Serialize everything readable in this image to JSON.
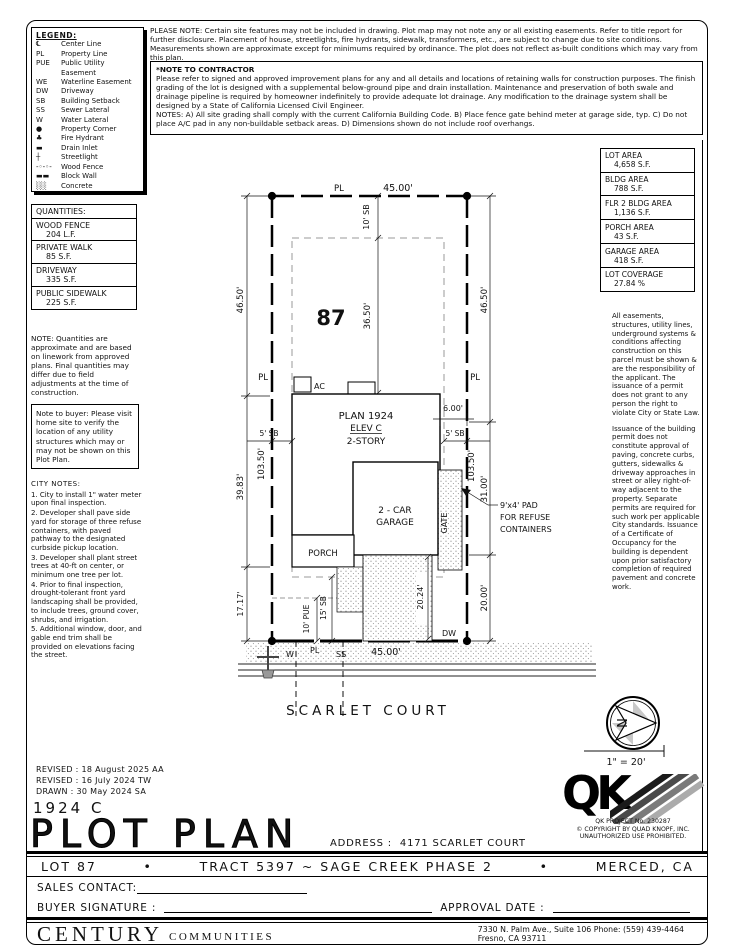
{
  "legend": {
    "title": "LEGEND:",
    "items": [
      {
        "symbol": "℄",
        "label": "Center Line"
      },
      {
        "symbol": "PL",
        "label": "Property Line"
      },
      {
        "symbol": "PUE",
        "label": "Public Utility Easement"
      },
      {
        "symbol": "WE",
        "label": "Waterline Easement"
      },
      {
        "symbol": "DW",
        "label": "Driveway"
      },
      {
        "symbol": "SB",
        "label": "Building Setback"
      },
      {
        "symbol": "SS",
        "label": "Sewer Lateral"
      },
      {
        "symbol": "W",
        "label": "Water Lateral"
      },
      {
        "symbol": "●",
        "label": "Property Corner"
      },
      {
        "symbol": "♣",
        "label": "Fire Hydrant"
      },
      {
        "symbol": "▬",
        "label": "Drain Inlet"
      },
      {
        "symbol": "┼",
        "label": "Streetlight"
      },
      {
        "symbol": "-◦-◦-",
        "label": "Wood Fence"
      },
      {
        "symbol": "▬▬",
        "label": "Block Wall"
      },
      {
        "symbol": "░░",
        "label": "Concrete"
      }
    ]
  },
  "please_note": "PLEASE NOTE:  Certain site features may not be included in drawing.  Plot map may not note any or all existing easements. Refer to title report for further disclosure.  Placement of house, streetlights, fire hydrants, sidewalk, transformers, etc., are subject to change due to site conditions.  Measurements shown are approximate except for minimums required by ordinance.  The plot does not reflect as-built conditions which may vary from this plan.",
  "contractor_note": {
    "title": "*NOTE TO CONTRACTOR",
    "body": "Please refer to signed and approved improvement plans for any and all details and locations of retaining walls for construction purposes. The finish grading of the lot is designed with a supplemental below-ground pipe and drain installation.  Maintenance and preservation of both swale and drainage pipeline is required by homeowner indefinitely to provide adequate lot drainage.  Any modification to the drainage system shall be designed by a State of California Licensed Civil Engineer.",
    "notes": "NOTES:  A) All site grading shall comply with the current California Building Code.  B) Place fence gate behind meter at garage side, typ.  C) Do not place A/C pad in any non-buildable setback areas.  D) Dimensions shown do not include roof overhangs."
  },
  "quantities": {
    "title": "QUANTITIES:",
    "rows": [
      {
        "label": "WOOD FENCE",
        "value": "204 L.F."
      },
      {
        "label": "PRIVATE WALK",
        "value": "85 S.F."
      },
      {
        "label": "DRIVEWAY",
        "value": "335 S.F."
      },
      {
        "label": "PUBLIC SIDEWALK",
        "value": "225 S.F."
      }
    ],
    "note": "NOTE: Quantities are approximate and are based on linework from approved plans.  Final quantities may differ due to field adjustments at the time of construction."
  },
  "buyer_note": "Note to buyer: Please visit home site to verify the location of any utility structures which may or may not be shown on this Plot Plan.",
  "city_notes": {
    "title": "CITY NOTES:",
    "items": [
      "1. City to install 1\" water meter upon final inspection.",
      "2. Developer shall pave side yard for storage of three refuse containers, with paved pathway to the designated curbside pickup location.",
      "3. Developer shall plant street trees at 40-ft on center, or minimum one tree per lot.",
      "4. Prior to final inspection, drought-tolerant front yard landscaping shall be provided, to include trees, ground cover, shrubs, and irrigation.",
      "5. Additional window, door, and gable end trim shall be provided on elevations facing the street."
    ]
  },
  "areas": {
    "rows": [
      {
        "label": "LOT AREA",
        "value": "4,658 S.F."
      },
      {
        "label": "BLDG AREA",
        "value": "788 S.F."
      },
      {
        "label": "FLR 2 BLDG AREA",
        "value": "1,136 S.F."
      },
      {
        "label": "PORCH AREA",
        "value": "43 S.F."
      },
      {
        "label": "GARAGE AREA",
        "value": "418 S.F."
      },
      {
        "label": "LOT COVERAGE",
        "value": "27.84 %"
      }
    ]
  },
  "right_notes": {
    "para1": "All easements, structures, utility lines, underground systems & conditions affecting construction on this parcel must be shown & are the responsibility of the applicant. The issuance of a permit does not grant to any person the right to violate City or State Law.",
    "para2": "Issuance of the building permit does not constitute approval of paving, concrete curbs, gutters, sidewalks & driveway approaches in street or alley right-of-way adjacent to the property. Separate permits are required for such work per applicable City standards. Issuance of a Certificate of Occupancy for the building is dependent upon prior satisfactory completion of required pavement and concrete work."
  },
  "plan": {
    "lot_number": "87",
    "pl": "PL",
    "street": "SCARLET COURT",
    "labels": {
      "ac": "AC",
      "plan1": "PLAN 1924",
      "plan2": "ELEV C",
      "plan3": "2-STORY",
      "garage1": "2 - CAR",
      "garage2": "GARAGE",
      "porch": "PORCH",
      "gate": "GATE",
      "dw": "DW",
      "w": "W",
      "ss": "SS",
      "refuse1": "9'x4' PAD",
      "refuse2": "FOR REFUSE",
      "refuse3": "CONTAINERS"
    },
    "dims": {
      "top_width": "45.00'",
      "front_sb": "10' SB",
      "to_house": "36.50'",
      "left1": "46.50'",
      "left2": "39.83'",
      "left3": "17.17'",
      "left_total": "103.50'",
      "right1": "46.50'",
      "right2": "31.00'",
      "right3": "20.00'",
      "right_total": "103.50'",
      "sb_left": "5' SB",
      "sb_right": "5' SB",
      "side": "6.00'",
      "pue": "10' PUE",
      "street_sb": "15' SB",
      "drive": "20.24'",
      "bottom_width": "45.00'"
    }
  },
  "compass": {
    "letter": "N",
    "scale": "1\" = 20'"
  },
  "revisions": [
    "REVISED : 18 August 2025  AA",
    "REVISED : 16 July 2024  TW",
    "DRAWN :  30 May 2024  SA"
  ],
  "title_block": {
    "plan_code": "1924 C",
    "title": "PLOT PLAN",
    "address_label": "ADDRESS :",
    "address": "4171 SCARLET COURT"
  },
  "qk": {
    "letters": "QK",
    "project": "QK PROJECT No. 230287",
    "copyright1": "© COPYRIGHT BY QUAD KNOPF, INC.",
    "copyright2": "UNAUTHORIZED USE PROHIBITED."
  },
  "footer": {
    "lot": "LOT 87",
    "bullet": "•",
    "tract": "TRACT 5397 ~ SAGE CREEK PHASE 2",
    "city": "MERCED, CA",
    "sales": "SALES CONTACT:",
    "buyer": "BUYER SIGNATURE :",
    "approval": "APPROVAL DATE :",
    "company_main": "CENTURY",
    "company_sub": "COMMUNITIES",
    "addr1": "7330 N. Palm Ave., Suite 106   Phone: (559) 439-4464",
    "addr2": "Fresno, CA  93711"
  }
}
